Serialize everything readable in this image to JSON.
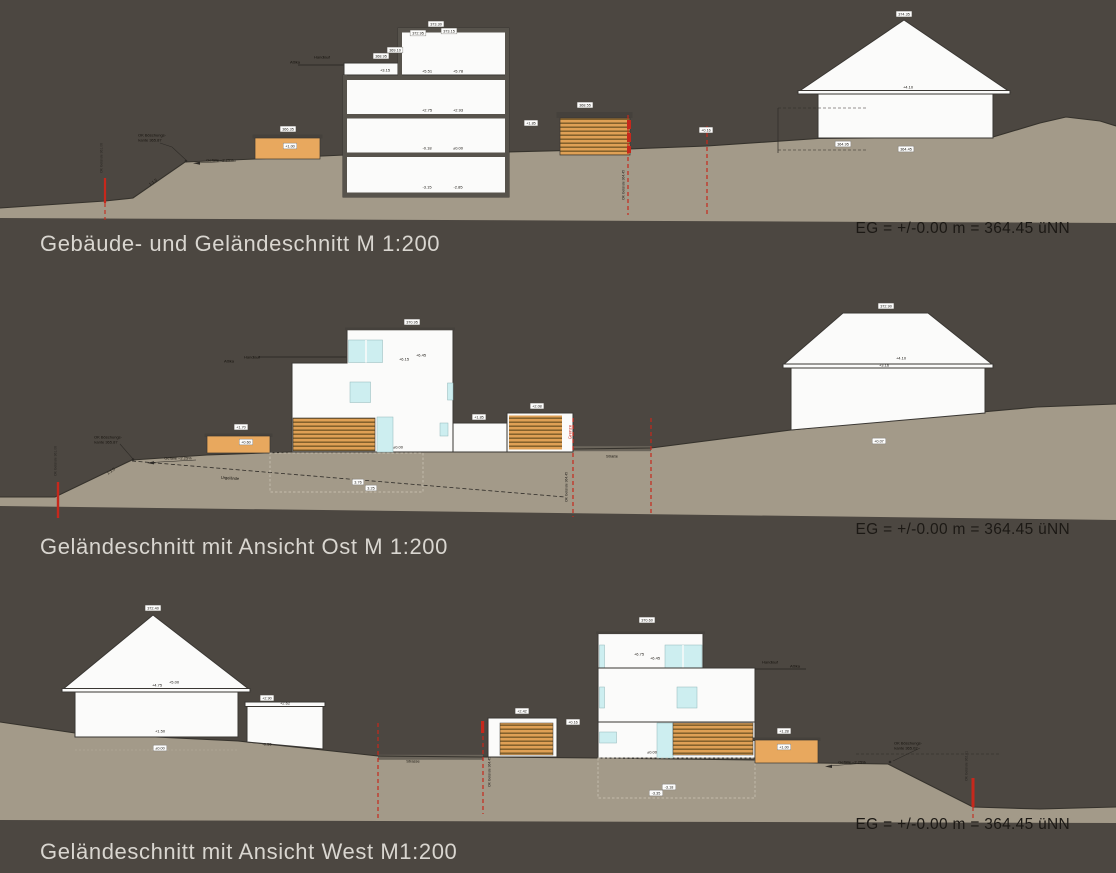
{
  "sheet": {
    "background_color": "#4c4741",
    "terrain_color": "#a39a89",
    "wood_color": "#dfa055",
    "accent_red": "#c6281c",
    "window_color": "#cdeef0"
  },
  "sections": [
    {
      "title": "Gebäude- und Geländeschnitt M 1:200",
      "datum": "EG = +/-0.00 m = 364.45 üNN",
      "annotations": [
        {
          "t": "372.95",
          "x": 418,
          "y": 33,
          "k": "box"
        },
        {
          "t": "373.30",
          "x": 436,
          "y": 24,
          "k": "box"
        },
        {
          "t": "373.15",
          "x": 449,
          "y": 31,
          "k": "box"
        },
        {
          "t": "368.95",
          "x": 381,
          "y": 56,
          "k": "box"
        },
        {
          "t": "369.10",
          "x": 395,
          "y": 50,
          "k": "box"
        },
        {
          "t": "+3.15",
          "x": 385,
          "y": 70,
          "k": "plain"
        },
        {
          "t": "366.35",
          "x": 288,
          "y": 129,
          "k": "box"
        },
        {
          "t": "+1.00",
          "x": 290,
          "y": 146,
          "k": "box"
        },
        {
          "t": "368.55",
          "x": 585,
          "y": 105,
          "k": "box"
        },
        {
          "t": "+1.85",
          "x": 531,
          "y": 123,
          "k": "box"
        },
        {
          "t": "+0.16",
          "x": 706,
          "y": 130,
          "k": "box"
        },
        {
          "t": "364.95",
          "x": 843,
          "y": 144,
          "k": "box"
        },
        {
          "t": "364.45",
          "x": 906,
          "y": 149,
          "k": "box"
        },
        {
          "t": "374.35",
          "x": 904,
          "y": 14,
          "k": "box"
        },
        {
          "t": "Attika",
          "x": 295,
          "y": 62,
          "k": "plain"
        },
        {
          "t": "Handlauf",
          "x": 322,
          "y": 57,
          "k": "plain"
        },
        {
          "t": "+5.51",
          "x": 427,
          "y": 71,
          "k": "plain"
        },
        {
          "t": "+5.78",
          "x": 458,
          "y": 71,
          "k": "plain"
        },
        {
          "t": "+2.75",
          "x": 427,
          "y": 110,
          "k": "plain"
        },
        {
          "t": "+2.93",
          "x": 458,
          "y": 110,
          "k": "plain"
        },
        {
          "t": "-0.18",
          "x": 427,
          "y": 148,
          "k": "plain"
        },
        {
          "t": "±0.00",
          "x": 458,
          "y": 148,
          "k": "plain"
        },
        {
          "t": "-3.15",
          "x": 427,
          "y": 187,
          "k": "plain"
        },
        {
          "t": "-2.85",
          "x": 458,
          "y": 187,
          "k": "plain"
        },
        {
          "t": "OK Böschungs-",
          "x": 152,
          "y": 135,
          "k": "plain"
        },
        {
          "t": "kante 365.87",
          "x": 150,
          "y": 140,
          "k": "plain"
        },
        {
          "t": "Gefälle ~2.25%",
          "x": 220,
          "y": 160,
          "k": "plain"
        },
        {
          "t": "1:1.5",
          "x": 153,
          "y": 182,
          "k": "plain",
          "rot": -35
        },
        {
          "t": "+4.10",
          "x": 908,
          "y": 87,
          "k": "plain"
        },
        {
          "t": "OK Gelände 361.06",
          "x": 101,
          "y": 158,
          "k": "vert"
        },
        {
          "t": "OK Gelände 364.45",
          "x": 623,
          "y": 185,
          "k": "vert"
        }
      ]
    },
    {
      "title": "Geländeschnitt mit Ansicht Ost M 1:200",
      "datum": "EG = +/-0.00 m = 364.45 üNN",
      "annotations": [
        {
          "t": "370.95",
          "x": 412,
          "y": 31,
          "k": "box"
        },
        {
          "t": "372.90",
          "x": 886,
          "y": 15,
          "k": "box"
        },
        {
          "t": "+1.70",
          "x": 241,
          "y": 136,
          "k": "box"
        },
        {
          "t": "+0.60",
          "x": 246,
          "y": 151,
          "k": "box"
        },
        {
          "t": "+1.85",
          "x": 479,
          "y": 126,
          "k": "box"
        },
        {
          "t": "+2.08",
          "x": 537,
          "y": 115,
          "k": "box"
        },
        {
          "t": "+0.07",
          "x": 879,
          "y": 150,
          "k": "box"
        },
        {
          "t": "3.76",
          "x": 358,
          "y": 191,
          "k": "box"
        },
        {
          "t": "3.25",
          "x": 371,
          "y": 197,
          "k": "box"
        },
        {
          "t": "Attika",
          "x": 229,
          "y": 70,
          "k": "plain"
        },
        {
          "t": "Handlauf",
          "x": 252,
          "y": 66,
          "k": "plain"
        },
        {
          "t": "+6.15",
          "x": 404,
          "y": 68,
          "k": "plain"
        },
        {
          "t": "+6.45",
          "x": 421,
          "y": 64,
          "k": "plain"
        },
        {
          "t": "±0.00",
          "x": 398,
          "y": 156,
          "k": "plain"
        },
        {
          "t": "OK Böschungs-",
          "x": 108,
          "y": 146,
          "k": "plain"
        },
        {
          "t": "kante 365.87",
          "x": 106,
          "y": 151,
          "k": "plain"
        },
        {
          "t": "Gefälle ~2.25%",
          "x": 178,
          "y": 167,
          "k": "plain"
        },
        {
          "t": "1:1.5",
          "x": 111,
          "y": 180,
          "k": "plain",
          "rot": -35
        },
        {
          "t": "Urgelände",
          "x": 230,
          "y": 187,
          "k": "plain",
          "rot": 4
        },
        {
          "t": "Straße",
          "x": 612,
          "y": 165,
          "k": "plain"
        },
        {
          "t": "+4.10",
          "x": 901,
          "y": 67,
          "k": "plain"
        },
        {
          "t": "+3.16",
          "x": 884,
          "y": 74,
          "k": "plain"
        },
        {
          "t": "OK Gelände 361.06",
          "x": 55,
          "y": 170,
          "k": "vert"
        },
        {
          "t": "OK Gelände 364.45",
          "x": 566,
          "y": 196,
          "k": "vert"
        },
        {
          "t": "Grenze",
          "x": 570,
          "y": 141,
          "k": "redvert"
        }
      ]
    },
    {
      "title": "Geländeschnitt mit Ansicht West M1:200",
      "datum": "EG = +/-0.00 m = 364.45 üNN",
      "annotations": [
        {
          "t": "372.40",
          "x": 153,
          "y": 26,
          "k": "box"
        },
        {
          "t": "+2.90",
          "x": 267,
          "y": 116,
          "k": "box"
        },
        {
          "t": "+2.42",
          "x": 522,
          "y": 129,
          "k": "box"
        },
        {
          "t": "370.60",
          "x": 647,
          "y": 38,
          "k": "box"
        },
        {
          "t": "+1.28",
          "x": 784,
          "y": 149,
          "k": "box"
        },
        {
          "t": "+1.00",
          "x": 784,
          "y": 165,
          "k": "box"
        },
        {
          "t": "+0.16",
          "x": 573,
          "y": 140,
          "k": "box"
        },
        {
          "t": "-3.18",
          "x": 669,
          "y": 205,
          "k": "box"
        },
        {
          "t": "-3.35",
          "x": 656,
          "y": 211,
          "k": "box"
        },
        {
          "t": "±0.00",
          "x": 160,
          "y": 166,
          "k": "box"
        },
        {
          "t": "+4.75",
          "x": 157,
          "y": 103,
          "k": "plain"
        },
        {
          "t": "+5.00",
          "x": 174,
          "y": 100,
          "k": "plain"
        },
        {
          "t": "+1.50",
          "x": 160,
          "y": 149,
          "k": "plain"
        },
        {
          "t": "+2.62",
          "x": 285,
          "y": 121,
          "k": "plain"
        },
        {
          "t": "-0.55",
          "x": 267,
          "y": 162,
          "k": "plain"
        },
        {
          "t": "Strasse",
          "x": 413,
          "y": 179,
          "k": "plain"
        },
        {
          "t": "+6.75",
          "x": 639,
          "y": 72,
          "k": "plain"
        },
        {
          "t": "+6.45",
          "x": 655,
          "y": 76,
          "k": "plain"
        },
        {
          "t": "±0.00",
          "x": 652,
          "y": 170,
          "k": "plain"
        },
        {
          "t": "Handlauf",
          "x": 770,
          "y": 80,
          "k": "plain"
        },
        {
          "t": "Attika",
          "x": 795,
          "y": 84,
          "k": "plain"
        },
        {
          "t": "OK Böschungs-",
          "x": 908,
          "y": 161,
          "k": "plain"
        },
        {
          "t": "kante 365.02",
          "x": 906,
          "y": 166,
          "k": "plain"
        },
        {
          "t": "Gefälle ~2.25%",
          "x": 852,
          "y": 180,
          "k": "plain"
        },
        {
          "t": "OK Gelände 364.45",
          "x": 489,
          "y": 190,
          "k": "vert"
        },
        {
          "t": "OK Gelände 362.01",
          "x": 966,
          "y": 184,
          "k": "vert"
        }
      ]
    }
  ]
}
